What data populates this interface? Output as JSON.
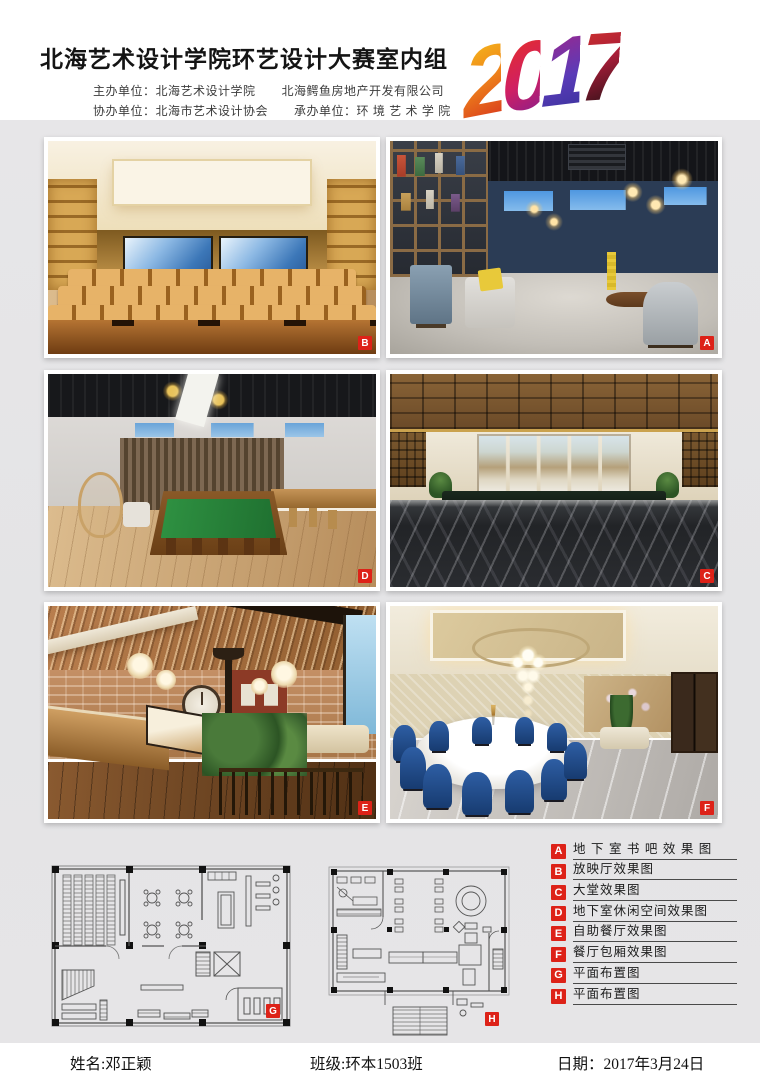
{
  "header": {
    "title": "北海艺术设计学院环艺设计大赛室内组",
    "line1_label": "主办单位：",
    "line1_value": "北海艺术设计学院",
    "line1_value2": "北海鳄鱼房地产开发有限公司",
    "line2_label": "协办单位：",
    "line2_value": "北海市艺术设计协会",
    "line2_label2": "承办单位：",
    "line2_value2": "环 境 艺 术 学 院",
    "year_digits": [
      "2",
      "0",
      "1",
      "7"
    ]
  },
  "photos": [
    {
      "tag": "B",
      "desc": "放映厅效果图"
    },
    {
      "tag": "A",
      "desc": "地下室书吧效果图"
    },
    {
      "tag": "D",
      "desc": "地下室休闲空间效果图"
    },
    {
      "tag": "C",
      "desc": "大堂效果图"
    },
    {
      "tag": "E",
      "desc": "自助餐厅效果图"
    },
    {
      "tag": "F",
      "desc": "餐厅包厢效果图"
    }
  ],
  "plans": [
    {
      "tag": "G",
      "desc": "平面布置图"
    },
    {
      "tag": "H",
      "desc": "平面布置图"
    }
  ],
  "legend": {
    "items": [
      {
        "tag": "A",
        "label": "地 下 室 书 吧 效 果 图"
      },
      {
        "tag": "B",
        "label": "放映厅效果图"
      },
      {
        "tag": "C",
        "label": "大堂效果图"
      },
      {
        "tag": "D",
        "label": "地下室休闲空间效果图"
      },
      {
        "tag": "E",
        "label": "自助餐厅效果图"
      },
      {
        "tag": "F",
        "label": "餐厅包厢效果图"
      },
      {
        "tag": "G",
        "label": "平面布置图"
      },
      {
        "tag": "H",
        "label": "平面布置图"
      }
    ]
  },
  "footer": {
    "name": "姓名:邓正颖",
    "class": "班级:环本1503班",
    "date": "日期：2017年3月24日"
  },
  "colors": {
    "accent_red": "#dd2218",
    "body_bg": "#e5e5e7"
  }
}
